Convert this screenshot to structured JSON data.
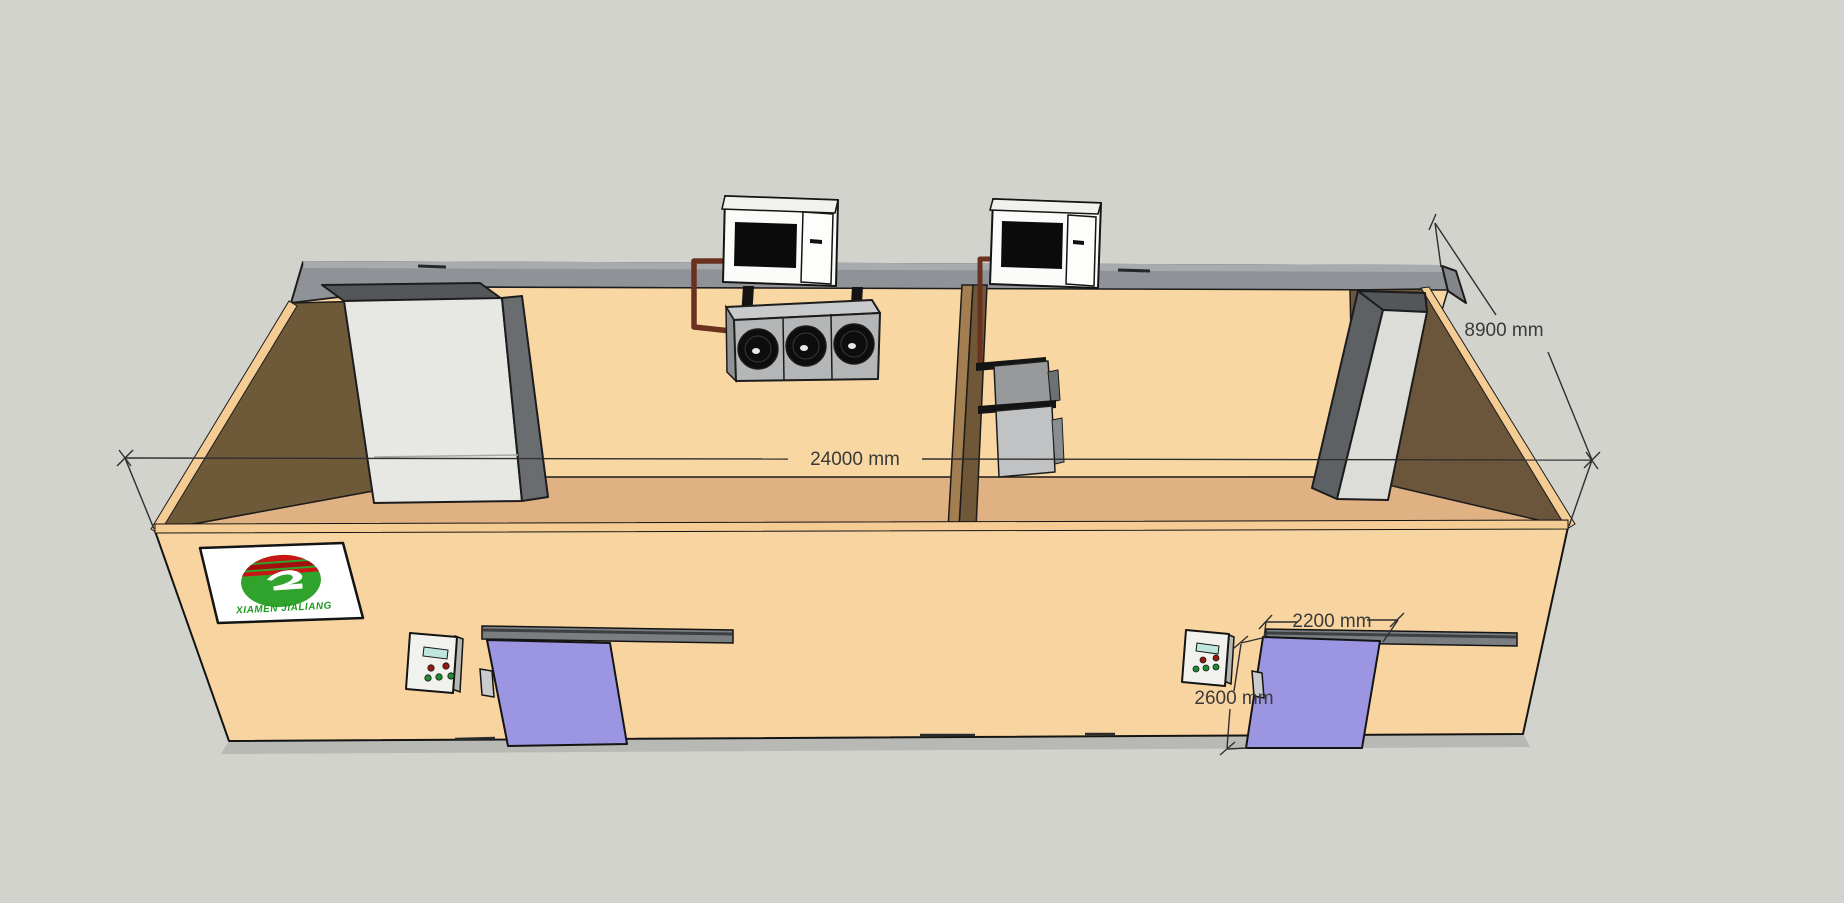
{
  "scene": {
    "description": "3D model view of a two-room cold storage building with roof-mounted condensing units, interior evaporators, concrete columns and sliding cold-room doors",
    "background_color": "#D2D3CD"
  },
  "dimensions": {
    "building_length": "24000 mm",
    "building_depth": "8900 mm",
    "door_width": "2200 mm",
    "door_height": "2600 mm"
  },
  "logo": {
    "company": "XIAMEN JIALIANG"
  },
  "equipment": {
    "condensing_units": 2,
    "evaporators": 2,
    "sliding_doors": 2,
    "control_panels": 2
  },
  "colors": {
    "wall_panel": "#F8D5A0",
    "floor": "#E0B182",
    "interior_shadow_wall": "#6E5939",
    "roof_edge": "#8F9296",
    "sliding_door": "#9B95E2",
    "refrigerant_pipe": "#6B3120",
    "column_concrete": "#E7E7E3",
    "partition_wood": "#A37E50",
    "condensing_unit_body": "#FBFBF9",
    "condensing_unit_grille": "#0B0B0B",
    "control_screen": "#BFE6DC",
    "button_red": "#991712",
    "button_green": "#1F8C2E",
    "dimension_text": "#3A3A3A",
    "logo_green": "#2FA32B",
    "logo_red": "#C81414",
    "logo_text_green": "#1E9C1E"
  }
}
